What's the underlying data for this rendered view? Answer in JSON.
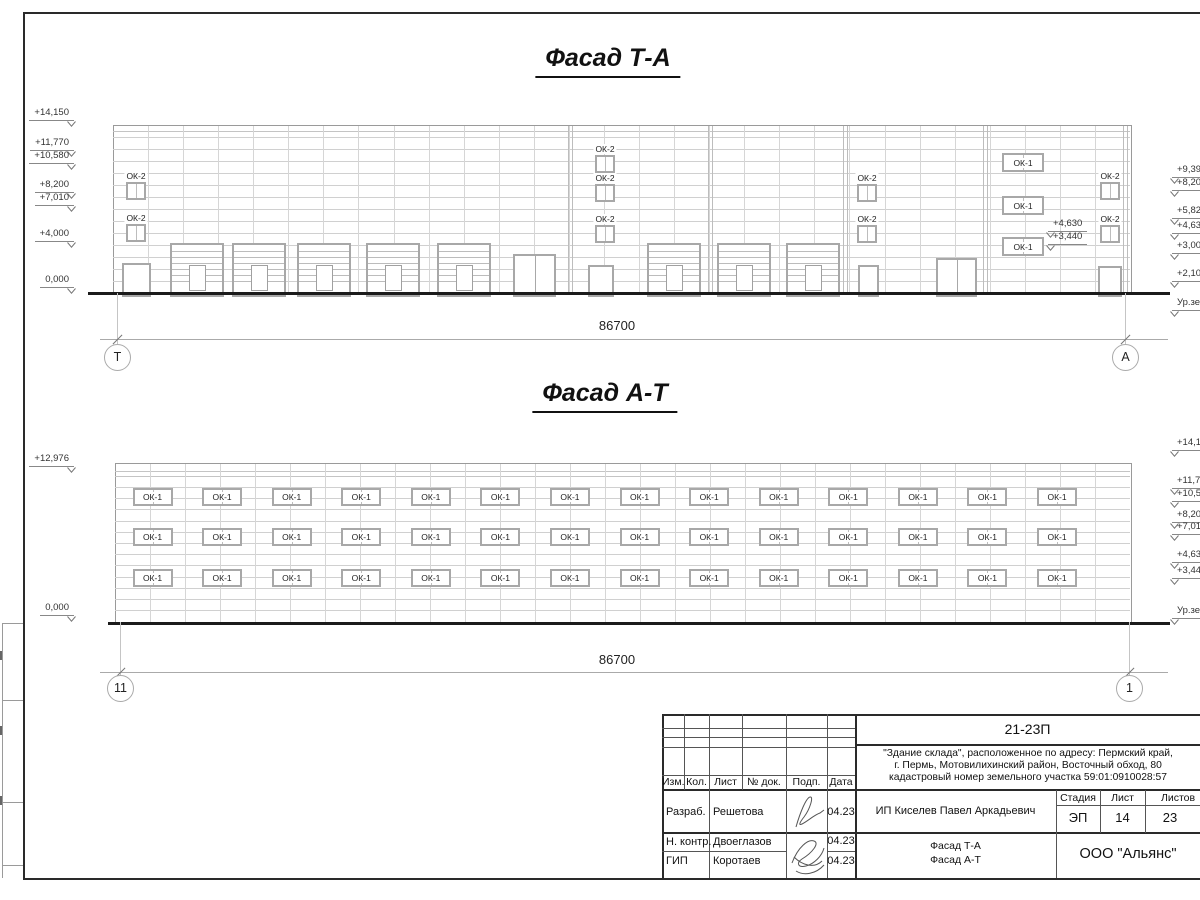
{
  "titles": {
    "facade_top": "Фасад Т-А",
    "facade_bottom": "Фасад А-Т"
  },
  "labels": {
    "ok1": "ОК-1",
    "ok2": "ОК-2"
  },
  "facades": [
    {
      "key": "ta",
      "bld": {
        "x": 113,
        "y": 125,
        "w": 1017,
        "h": 168
      },
      "extra_hlines": [
        131
      ],
      "hlines": {
        "start": 137,
        "step": 12,
        "count": 13
      },
      "vbays": 29,
      "pilasters": [
        570,
        710,
        845,
        985,
        1125
      ],
      "gates": {
        "xs": [
          170,
          232,
          297,
          366,
          437,
          647,
          717,
          786
        ],
        "y": 243,
        "w": 50,
        "h": 50
      },
      "doors": [
        {
          "x": 122,
          "w": 25,
          "y": 263,
          "h": 30,
          "leaves": 1
        },
        {
          "x": 513,
          "w": 39,
          "y": 254,
          "h": 39,
          "leaves": 2
        },
        {
          "x": 588,
          "w": 22,
          "y": 265,
          "h": 28,
          "leaves": 1
        },
        {
          "x": 858,
          "w": 17,
          "y": 265,
          "h": 28,
          "leaves": 1
        },
        {
          "x": 936,
          "w": 37,
          "y": 258,
          "h": 35,
          "leaves": 2
        },
        {
          "x": 1098,
          "w": 20,
          "y": 266,
          "h": 27,
          "leaves": 1
        }
      ],
      "ok2": {
        "w": 16,
        "h": 14,
        "items": [
          [
            126,
            182
          ],
          [
            126,
            224
          ],
          [
            595,
            155
          ],
          [
            595,
            184
          ],
          [
            595,
            225
          ],
          [
            857,
            184
          ],
          [
            857,
            225
          ],
          [
            1100,
            182
          ],
          [
            1100,
            225
          ]
        ]
      },
      "ok1": {
        "w": 38,
        "h": 15,
        "items": [
          [
            1002,
            153
          ],
          [
            1002,
            196
          ],
          [
            1002,
            237
          ]
        ]
      },
      "grid": null,
      "mark_anchor_left": 74,
      "mark_anchor_right": 1172,
      "marks_left": [
        [
          "+14,150",
          120
        ],
        [
          "+11,770",
          150
        ],
        [
          "+10,580",
          163
        ],
        [
          "+8,200",
          192
        ],
        [
          "+7,010",
          205
        ],
        [
          "+4,000",
          241
        ],
        [
          "0,000",
          287
        ]
      ],
      "marks_right": [
        [
          "+9,39",
          177
        ],
        [
          "+8,20",
          190
        ],
        [
          "+5,82",
          218
        ],
        [
          "+4,63",
          233
        ],
        [
          "+3,000",
          253
        ],
        [
          "+2,10",
          281
        ],
        [
          "Ур.зе",
          310
        ]
      ],
      "inner_marks": [
        [
          "+4,630",
          1048,
          231
        ],
        [
          "+3,440",
          1048,
          244
        ]
      ],
      "ground": {
        "x": 88,
        "y": 292,
        "w": 1082
      },
      "dim": {
        "label": "86700",
        "y": 339,
        "x1": 100,
        "x2": 1168,
        "lx": 617,
        "ly": 318
      },
      "axes": [
        {
          "t": "Т",
          "x": 117
        },
        {
          "t": "А",
          "x": 1125
        }
      ],
      "axis_cy": 357
    },
    {
      "key": "at",
      "bld": {
        "x": 115,
        "y": 463,
        "w": 1015,
        "h": 159
      },
      "extra_hlines": [
        471,
        476
      ],
      "hlines": {
        "start": 487,
        "step": 11.2,
        "count": 12
      },
      "vbays": 29,
      "pilasters": [],
      "gates": null,
      "doors": [],
      "ok2": null,
      "ok1": null,
      "grid": {
        "cols": 14,
        "cx0": 150.5,
        "dx": 69.58,
        "w": 36,
        "h": 14,
        "rows": [
          488,
          528,
          569
        ]
      },
      "mark_anchor_left": 74,
      "mark_anchor_right": 1172,
      "marks_left": [
        [
          "+12,976",
          466
        ],
        [
          "0,000",
          615
        ]
      ],
      "marks_right": [
        [
          "+14,15",
          450
        ],
        [
          "+11,77",
          488
        ],
        [
          "+10,58",
          501
        ],
        [
          "+8,20",
          522
        ],
        [
          "+7,01",
          534
        ],
        [
          "+4,63",
          562
        ],
        [
          "+3,44",
          578
        ],
        [
          "Ур.зем",
          618
        ]
      ],
      "inner_marks": [],
      "ground": {
        "x": 108,
        "y": 622,
        "w": 1062
      },
      "dim": {
        "label": "86700",
        "y": 672,
        "x1": 100,
        "x2": 1168,
        "lx": 617,
        "ly": 652
      },
      "axes": [
        {
          "t": "11",
          "x": 120
        },
        {
          "t": "1",
          "x": 1129
        }
      ],
      "axis_cy": 688
    }
  ],
  "title_block": {
    "code": "21-23П",
    "description": [
      "\"Здание склада\", расположенное по адресу: Пермский край,",
      "г. Пермь, Мотовилихинский район, Восточный обход, 80",
      "кадастровый номер земельного участка 59:01:0910028:57"
    ],
    "header_cols": [
      "Изм.",
      "Кол.",
      "Лист",
      "№ док.",
      "Подп.",
      "Дата"
    ],
    "rows": [
      {
        "role": "Разраб.",
        "name": "Решетова",
        "date": "04.23"
      },
      {
        "role": "Н. контр.",
        "name": "Двоеглазов",
        "date": "04.23"
      },
      {
        "role": "ГИП",
        "name": "Коротаев",
        "date": "04.23"
      }
    ],
    "client": "ИП Киселев Павел Аркадьевич",
    "stage_header": [
      "Стадия",
      "Лист",
      "Листов"
    ],
    "stage_values": [
      "ЭП",
      "14",
      "23"
    ],
    "sheet_title": [
      "Фасад Т-А",
      "Фасад А-Т"
    ],
    "company": "ООО \"Альянс\""
  }
}
